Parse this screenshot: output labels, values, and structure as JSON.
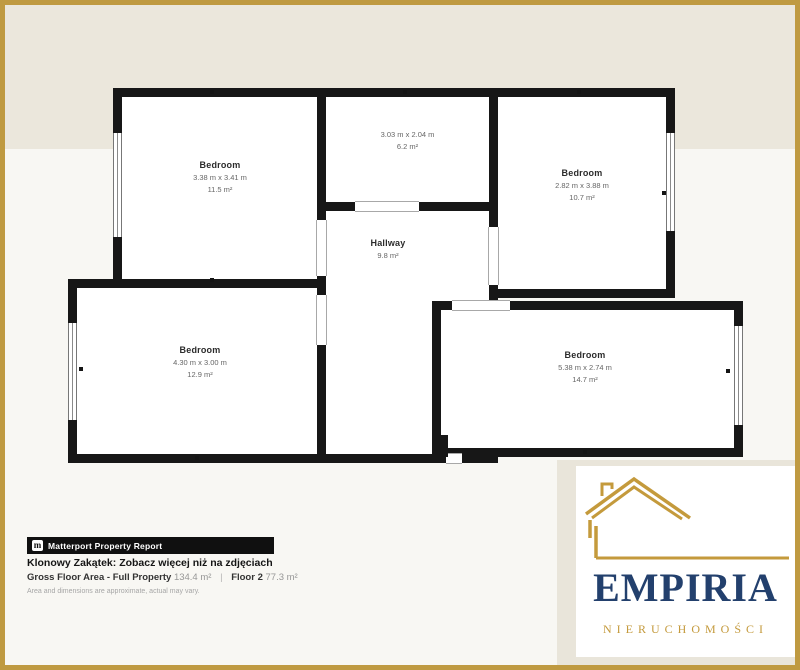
{
  "floorplan": {
    "rooms": [
      {
        "id": "bedroom-top-left",
        "name": "Bedroom",
        "dims": "3.38 m x 3.41 m",
        "area": "11.5 m²"
      },
      {
        "id": "room-top-middle",
        "name": "",
        "dims": "3.03 m x 2.04 m",
        "area": "6.2 m²"
      },
      {
        "id": "bedroom-top-right",
        "name": "Bedroom",
        "dims": "2.82 m x 3.88 m",
        "area": "10.7 m²"
      },
      {
        "id": "hallway",
        "name": "Hallway",
        "dims": "",
        "area": "9.8 m²"
      },
      {
        "id": "bedroom-bottom-left",
        "name": "Bedroom",
        "dims": "4.30 m x 3.00 m",
        "area": "12.9 m²"
      },
      {
        "id": "bedroom-bottom-right",
        "name": "Bedroom",
        "dims": "5.38 m x 2.74 m",
        "area": "14.7 m²"
      }
    ]
  },
  "report": {
    "badge": "Matterport Property Report",
    "badge_icon": "matterport-m-icon",
    "badge_icon_glyph": "m",
    "title": "Klonowy Zakątek: Zobacz więcej niż na zdjęciach",
    "gfa_label": "Gross Floor Area - Full Property",
    "gfa_value": "134.4 m²",
    "separator": "|",
    "floor_label": "Floor 2",
    "floor_value": "77.3 m²",
    "disclaimer": "Area and dimensions are approximate, actual may vary."
  },
  "brand": {
    "icon": "house-outline-icon",
    "name": "EMPIRIA",
    "subtitle": "NIERUCHOMOŚCI"
  },
  "colors": {
    "frame_gold": "#bf9a41",
    "logo_gold": "#c49a3c",
    "brand_navy": "#23406d",
    "wall_black": "#171717",
    "band_beige": "#ebe7dc"
  }
}
